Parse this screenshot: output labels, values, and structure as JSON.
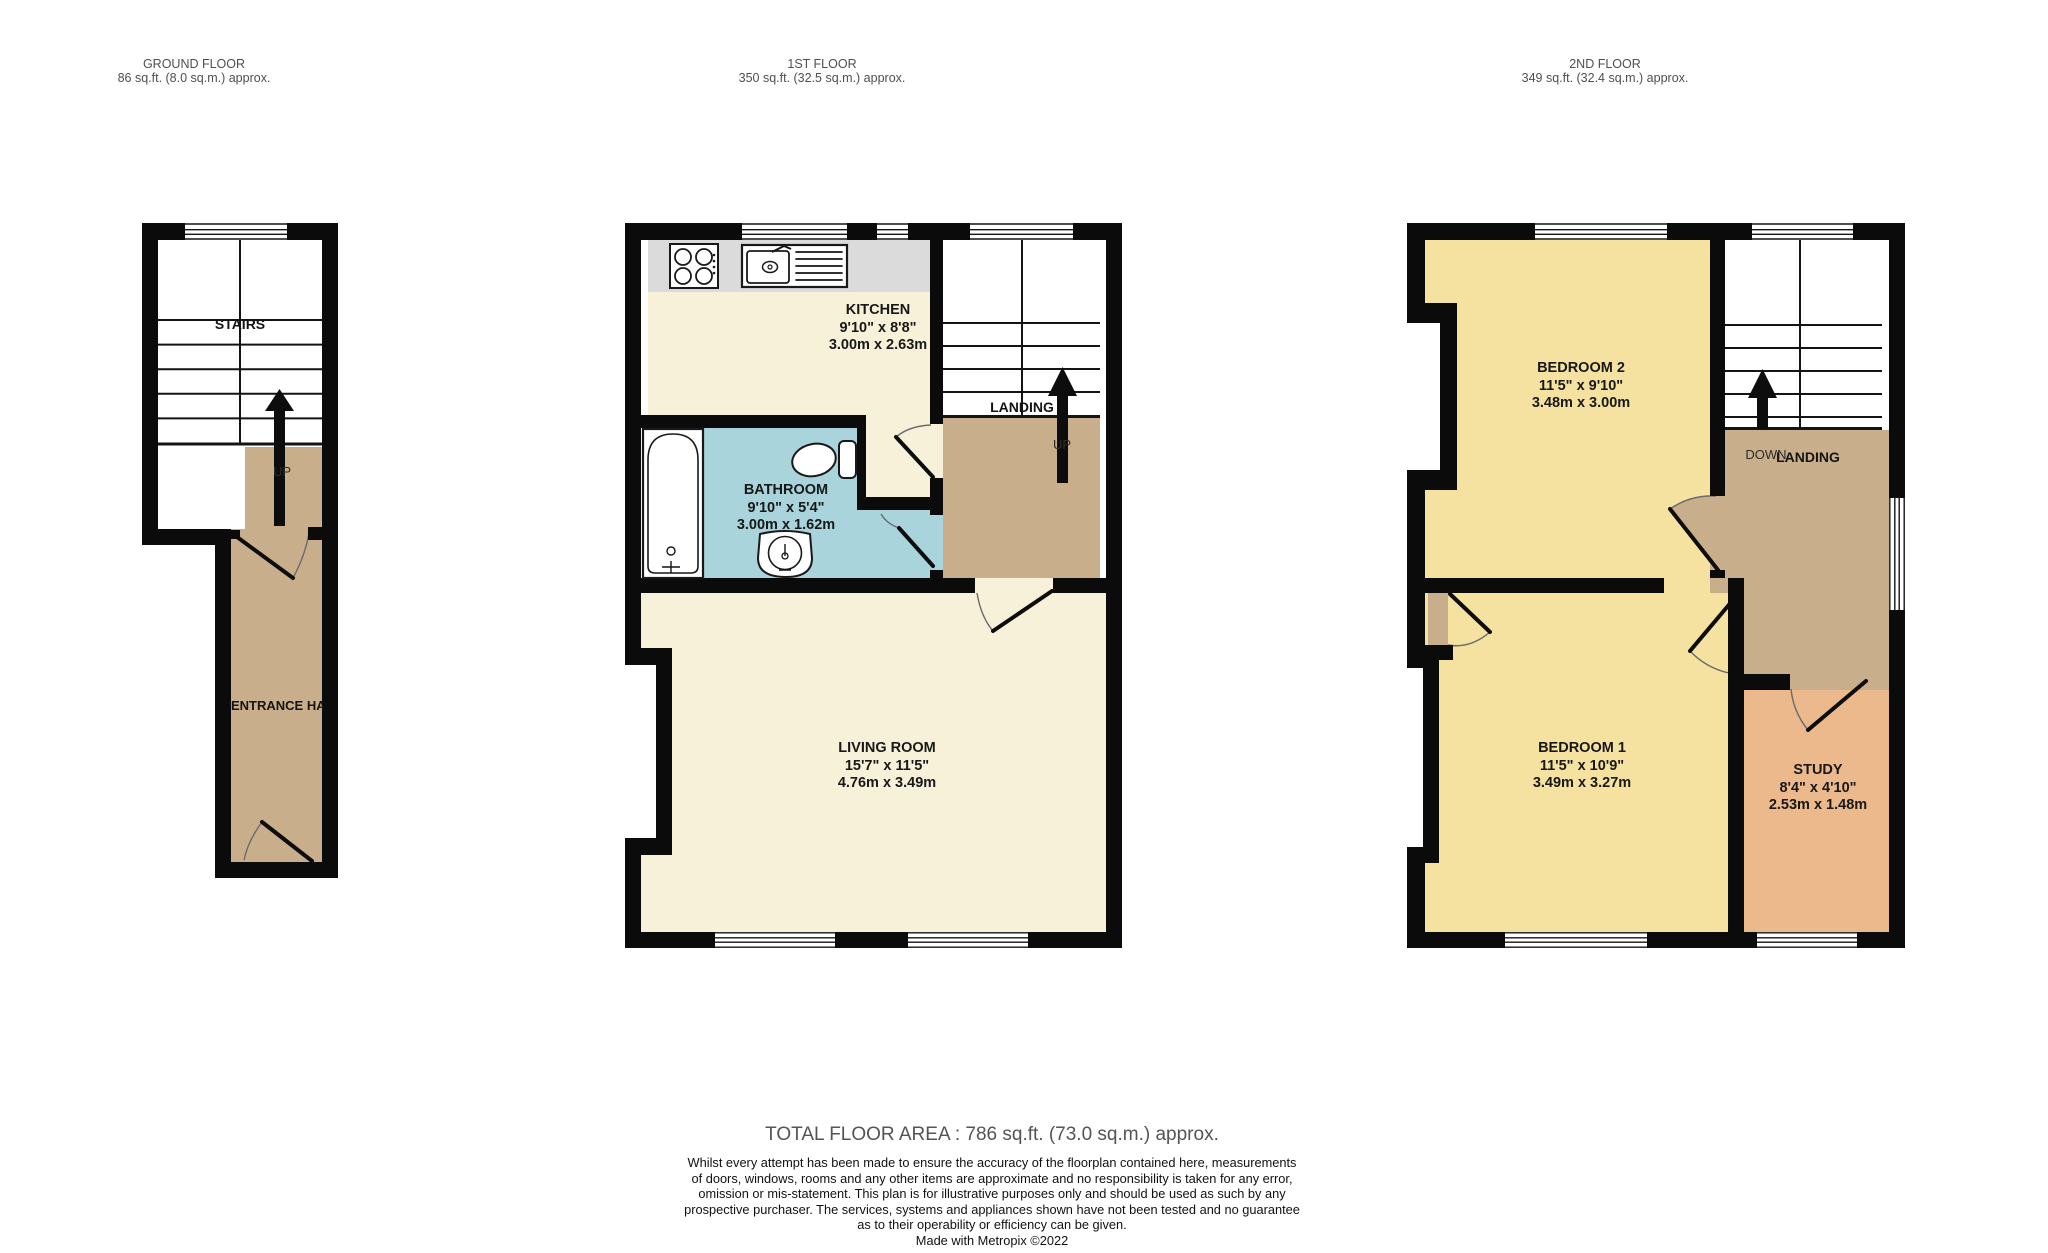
{
  "colors": {
    "wall": "#0b0b0b",
    "cream": "#f7f1d9",
    "yellow": "#f5e2a0",
    "tan": "#c9ae8b",
    "blue": "#a9d4dc",
    "salmon": "#ebb98c",
    "counter": "#dbdbdb"
  },
  "floors": [
    {
      "id": "ground",
      "title": "GROUND FLOOR",
      "area": "86 sq.ft. (8.0 sq.m.) approx.",
      "labels": {
        "stairs": "STAIRS",
        "up": "UP",
        "hall": "ENTRANCE HALL"
      }
    },
    {
      "id": "first",
      "title": "1ST FLOOR",
      "area": "350 sq.ft. (32.5 sq.m.) approx.",
      "labels": {
        "landing": "LANDING",
        "up": "UP"
      },
      "rooms": [
        {
          "name": "KITCHEN",
          "dims_imperial": "9'10\"  x 8'8\"",
          "dims_metric": "3.00m  x 2.63m"
        },
        {
          "name": "BATHROOM",
          "dims_imperial": "9'10\"  x 5'4\"",
          "dims_metric": "3.00m  x 1.62m"
        },
        {
          "name": "LIVING ROOM",
          "dims_imperial": "15'7\"  x 11'5\"",
          "dims_metric": "4.76m  x 3.49m"
        }
      ]
    },
    {
      "id": "second",
      "title": "2ND FLOOR",
      "area": "349 sq.ft. (32.4 sq.m.) approx.",
      "labels": {
        "landing": "LANDING",
        "down": "DOWN"
      },
      "rooms": [
        {
          "name": "BEDROOM 2",
          "dims_imperial": "11'5\"  x 9'10\"",
          "dims_metric": "3.48m  x 3.00m"
        },
        {
          "name": "BEDROOM 1",
          "dims_imperial": "11'5\"  x 10'9\"",
          "dims_metric": "3.49m  x 3.27m"
        },
        {
          "name": "STUDY",
          "dims_imperial": "8'4\"  x 4'10\"",
          "dims_metric": "2.53m  x 1.48m"
        }
      ]
    }
  ],
  "footer": {
    "total": "TOTAL FLOOR AREA : 786 sq.ft. (73.0 sq.m.) approx.",
    "disclaimer_lines": [
      "Whilst every attempt has been made to ensure the accuracy of the floorplan contained here, measurements",
      "of doors, windows, rooms and any other items are approximate and no responsibility is taken for any error,",
      "omission or mis-statement. This plan is for illustrative purposes only and should be used as such by any",
      "prospective purchaser. The services, systems and appliances shown have not been tested and no guarantee",
      "as to their operability or efficiency can be given."
    ],
    "credit": "Made with Metropix ©2022"
  }
}
